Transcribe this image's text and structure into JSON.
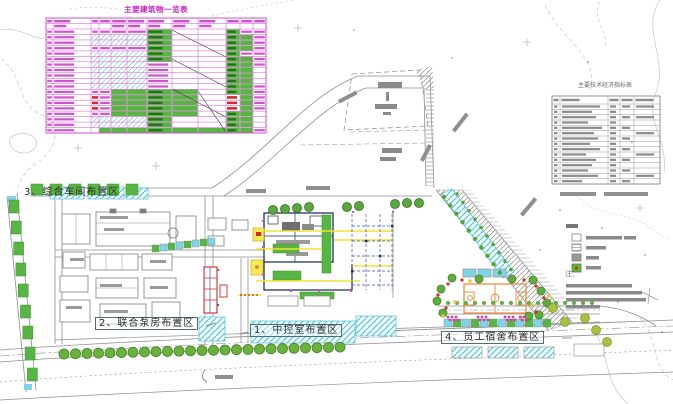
{
  "drawing_title": "厂区总平面布置图",
  "area_labels": [
    {
      "label": "1、中控室布置区"
    },
    {
      "label": "2、联合泵房布置区"
    },
    {
      "label": "3、综合车间布置区"
    },
    {
      "label": "4、员工宿舍布置区"
    }
  ],
  "building_table": {
    "title": "主要建筑物一览表",
    "rows": [
      "ttttttG..Gtt",
      "ttbbbbG..Ggt",
      "ttbbbbG..Ggt",
      "ttttttG..Ggt",
      "ttbbbbG..Gtt",
      "ttbbbbG..Ggt",
      "ttbbbbt..Ggt",
      "ttbbbbt..Gg.",
      "ttbbbbt..Gg.",
      "ttbbbbt..Gg.",
      "ttbbbbt..Ggt",
      "ttttggGg.Ggt",
      "ttrtggGg.rgt",
      "ttrtggGg.rgt",
      "ttrtggGg.rgt",
      "ttttggGg.Gg.",
      "ttbbbbG..Gg.",
      "ttbbbbG..Gg.",
      "tt.gggGggGgt"
    ]
  },
  "indicator_table": {
    "title": "主要技术经济指标表",
    "row_count": 15,
    "name_bar_widths": [
      38,
      30,
      34,
      26,
      40,
      32,
      36,
      28,
      38,
      24,
      34,
      30,
      26,
      36,
      20
    ]
  },
  "legend": {
    "items": [
      "新建建筑物",
      "道路",
      "硬化地面",
      "绿化"
    ]
  },
  "notes": {
    "label": "注："
  },
  "colors": {
    "table_line": "#cf52cf",
    "green": "#58b544",
    "green_dark": "#3f8f2e",
    "cyan": "#3ab5d8",
    "cyan_fill": "#7fd4ea",
    "yellow": "#f0e432",
    "navy": "#1c2f5e",
    "blue_grid": "#3b55a0",
    "red": "#d42a2a",
    "orange": "#e8853a",
    "magenta_dot": "#cc3fa8",
    "gray_line": "#8f8f8f",
    "contour": "#c6c6c6",
    "bar_gray": "#8a8a8a"
  }
}
